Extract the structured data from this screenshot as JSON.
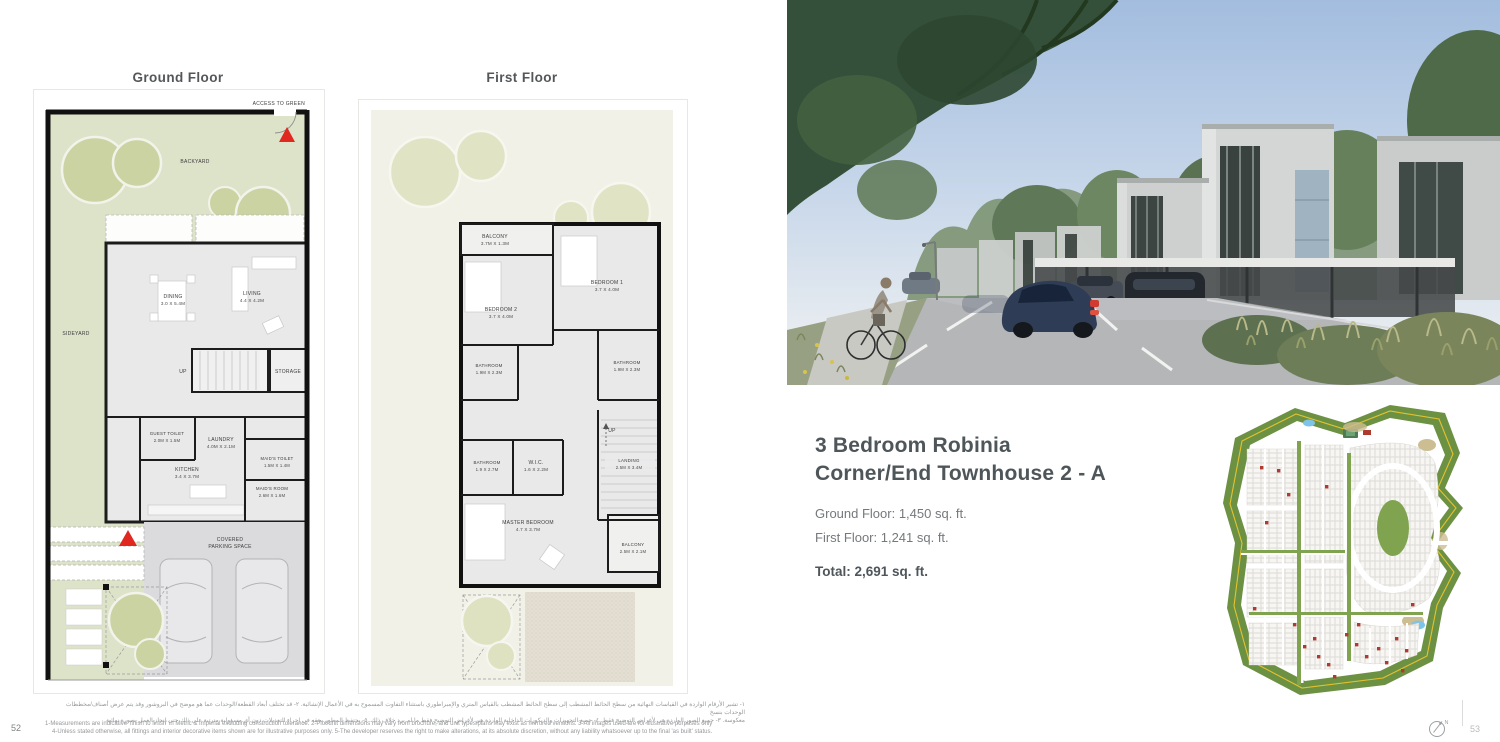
{
  "page": {
    "left_number": "52",
    "right_number": "53",
    "compass_n": "N"
  },
  "plans": {
    "ground": {
      "title": "Ground Floor",
      "access_label": "ACCESS TO  GREEN",
      "backyard": "BACKYARD",
      "sideyard": "SIDEYARD",
      "up": "UP",
      "storage": "STORAGE",
      "parking_line1": "COVERED",
      "parking_line2": "PARKING SPACE",
      "rooms": [
        {
          "name": "DINING",
          "dims": "3.0 X 5.4M"
        },
        {
          "name": "LIVING",
          "dims": "4.4 X 4.2M"
        },
        {
          "name": "GUEST TOILET",
          "dims": "2.0M X 1.5M"
        },
        {
          "name": "LAUNDRY",
          "dims": "4.0M X 2.1M"
        },
        {
          "name": "KITCHEN",
          "dims": "3.4 X 3.7M"
        },
        {
          "name": "MAID'S TOILET",
          "dims": "1.5M X 1.4M"
        },
        {
          "name": "MAID'S ROOM",
          "dims": "2.6M X 1.6M"
        }
      ]
    },
    "first": {
      "title": "First Floor",
      "up": "UP",
      "rooms": [
        {
          "name": "BALCONY",
          "dims": "3.7M X 1.3M"
        },
        {
          "name": "BEDROOM 1",
          "dims": "3.7 X 4.0M"
        },
        {
          "name": "BEDROOM 2",
          "dims": "3.7 X 4.0M"
        },
        {
          "name": "BATHROOM",
          "dims": "1.9M X 2.3M"
        },
        {
          "name": "BATHROOM",
          "dims": "1.9M X 2.3M"
        },
        {
          "name": "BATHROOM",
          "dims": "1.9 X 2.7M"
        },
        {
          "name": "W.I.C.",
          "dims": "1.6 X 2.2M"
        },
        {
          "name": "LANDING",
          "dims": "2.5M X 3.4M"
        },
        {
          "name": "MASTER BEDROOM",
          "dims": "4.7 X 3.7M"
        },
        {
          "name": "BALCONY",
          "dims": "2.5M X 2.1M"
        }
      ]
    }
  },
  "unit": {
    "title_line1": "3 Bedroom Robinia",
    "title_line2": "Corner/End Townhouse 2 - A",
    "ground_area": "Ground Floor: 1,450 sq. ft.",
    "first_area": "First Floor: 1,241 sq. ft.",
    "total_area": "Total: 2,691 sq. ft."
  },
  "footer": {
    "arabic_line1": "١- تشير الأرقام الواردة في القياسات النهائية من سطح الحائط المشطب إلى سطح الحائط المشطب بالقياس المتري والإمبراطوري باستثناء التفاوت المسموح به في الأعمال الإنشائية. ٢- قد تختلف أبعاد القطعة/الوحدات عما هو موضح في البروشور وقد يتم عرض أصناف/مخططات الوحدات بنسخ",
    "arabic_line2": "معكوسة. ٣- جميع الصور الواردة هي لأغراض التوضيح فقط. ٤- جميع التجهيزات والديكورات الداخلية الواردة هي لأغراض التوضيح فقط ما لم يرد خلاف ذلك. ٥- يحتفظ المطور بحقه في إجراء التعديلات دون أي مسؤولية مترتبة على ذلك حتى إنجاز العمل بصورة نهائية",
    "english_line1": "1-Measurements are indicative 'finish to finish' in Metric & Imperial excluding construction tolerance. 2-Plot/unit dimensions may vary from brochure, and unit types/plans may exist as mirrored versions. 3-All images used are for illustrative purposes only",
    "english_line2": "4-Unless stated otherwise, all fittings and interior decorative items shown are for illustrative purposes only. 5-The developer reserves the right to make alterations, at its absolute discretion, without any liability whatsoever up to the final 'as built' status."
  },
  "colors": {
    "accent_red": "#e02820",
    "plan_green": "#dde3c9",
    "map_green": "#6d9143",
    "map_road_yellow": "#e3c230",
    "pond_blue": "#7ec4e8",
    "title_gray": "#50565a"
  }
}
